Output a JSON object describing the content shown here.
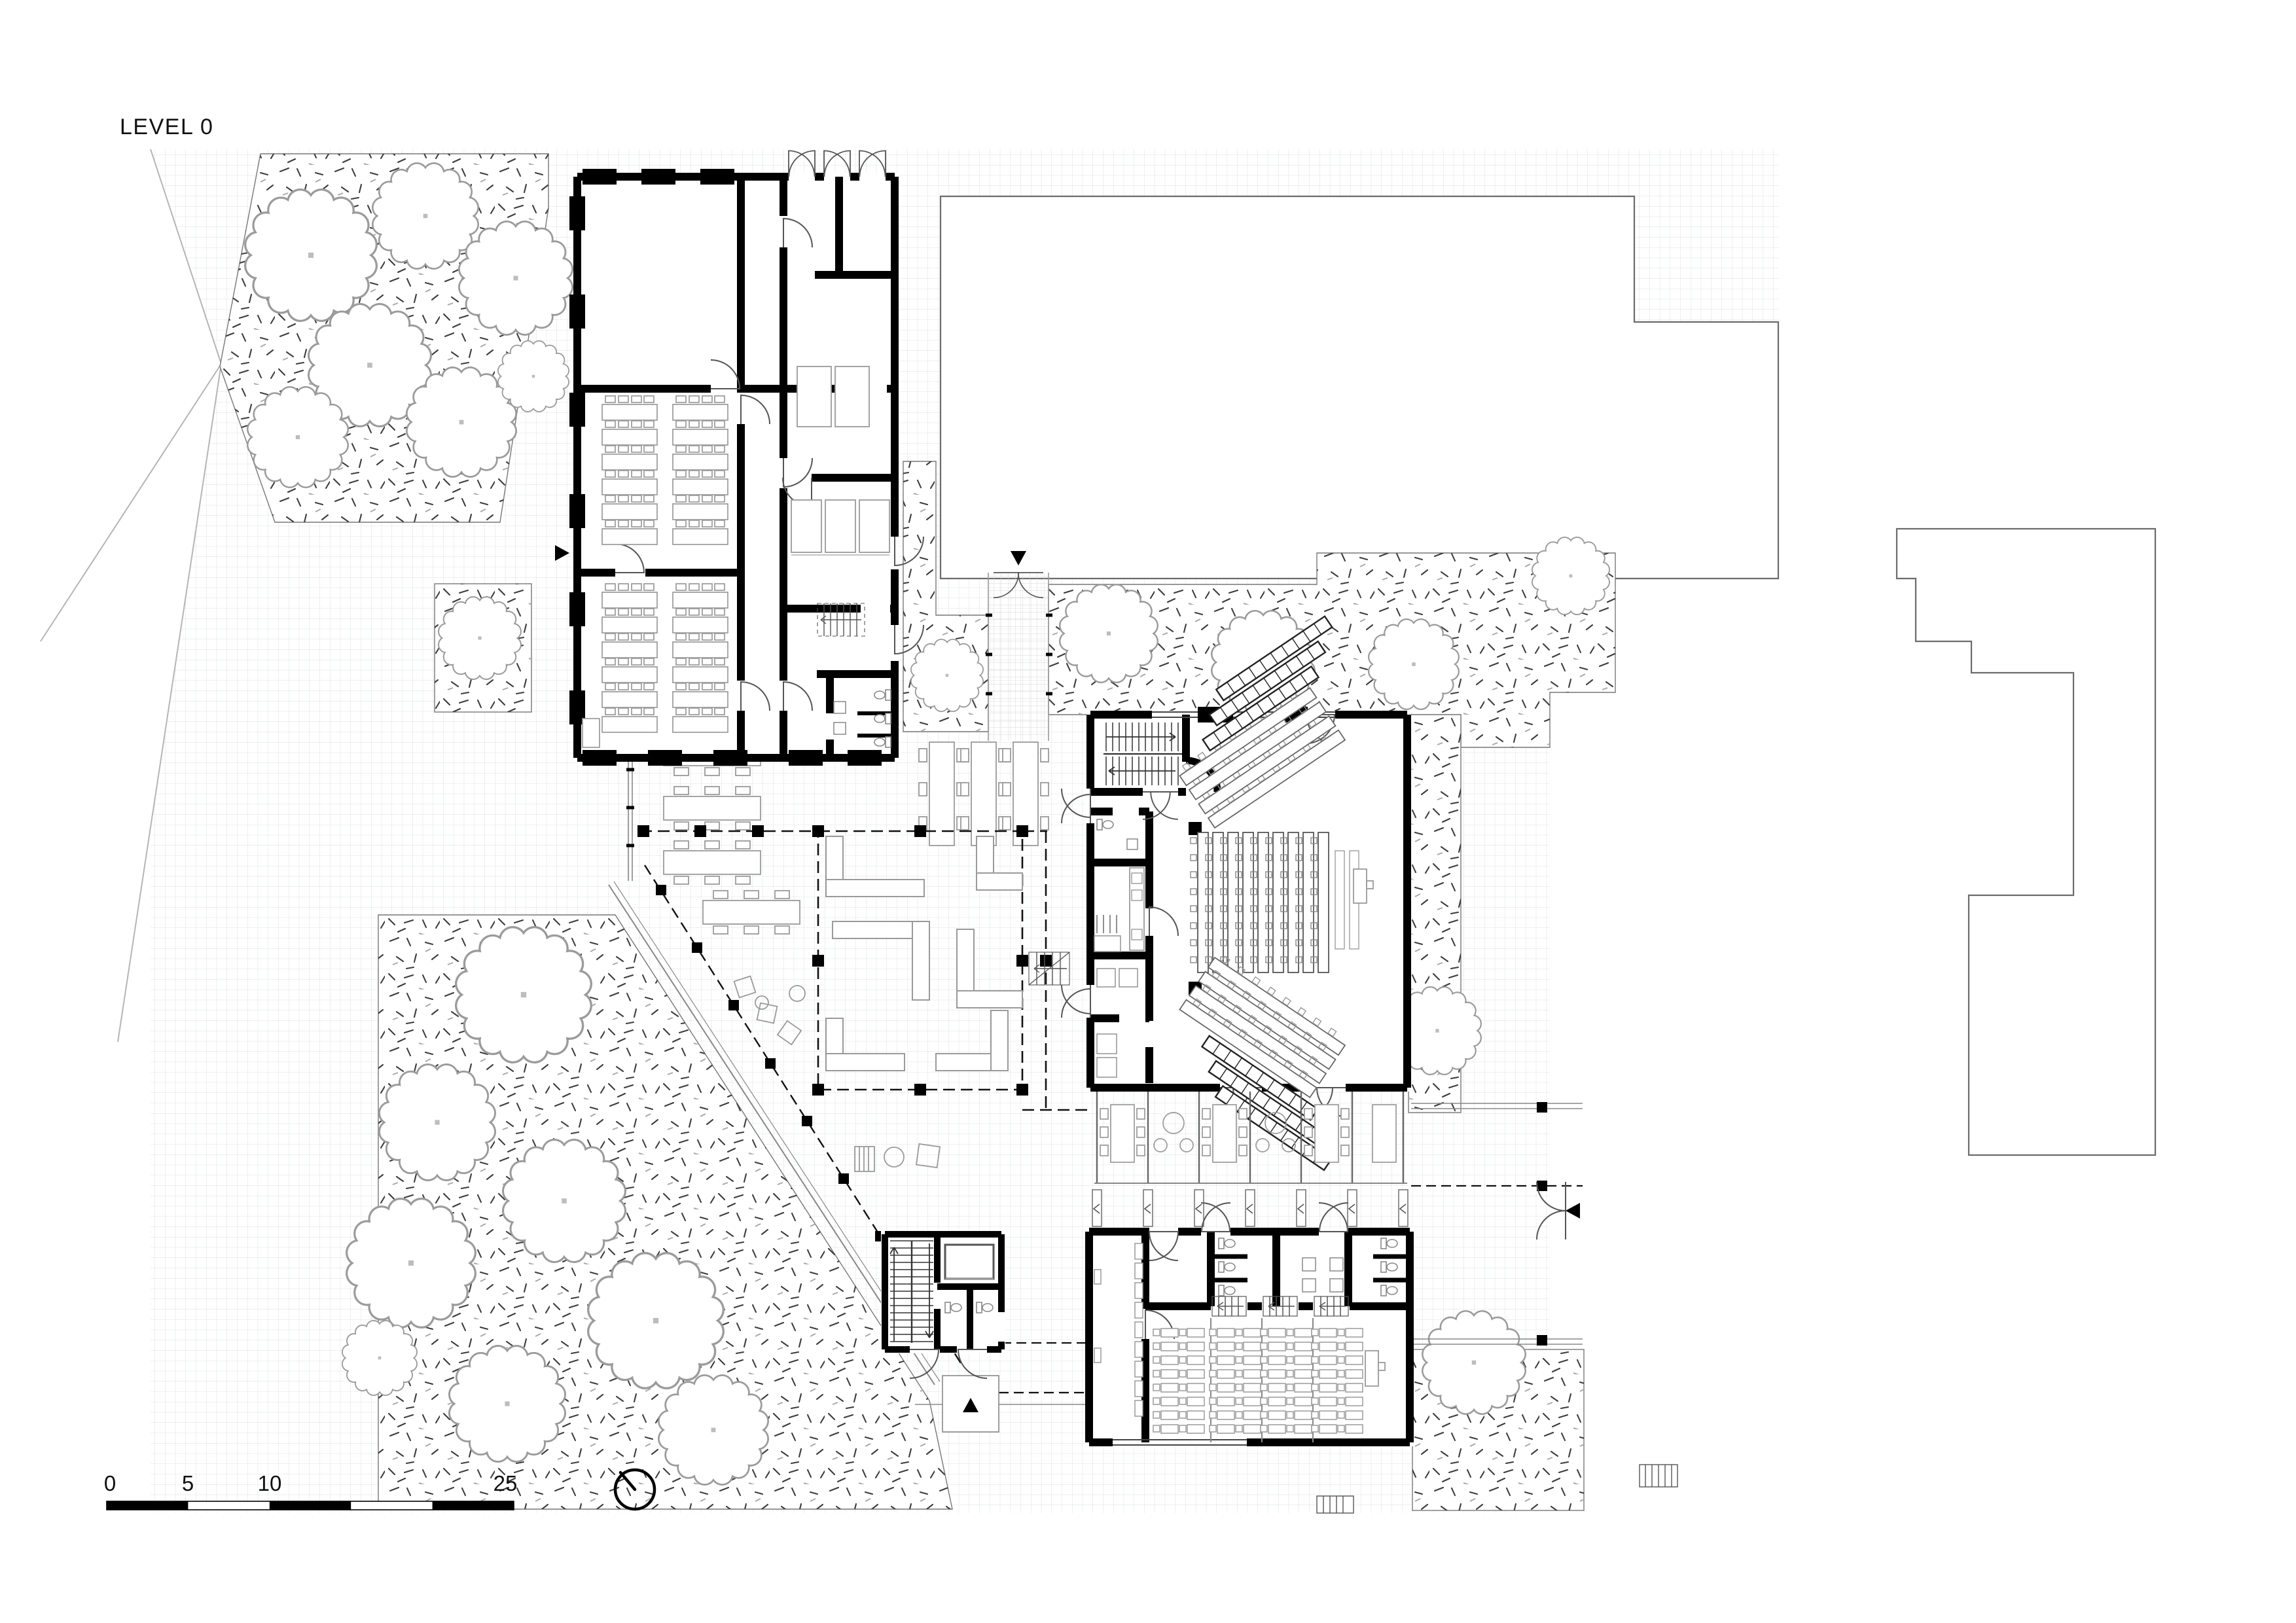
{
  "title": "LEVEL 0",
  "scale_bar": {
    "labels": [
      "0",
      "5",
      "10",
      "25"
    ],
    "values": [
      0,
      5,
      10,
      25
    ],
    "style": "alternating-black-white-bar"
  },
  "icons": {
    "north_indicator": "compass-circle-needle",
    "entrance_marker": "solid-triangle",
    "tree": "scalloped-canopy-outline",
    "stair": "parallel-treads-with-arrow",
    "door": "quarter-circle-swing"
  },
  "palette": {
    "wall": "#000000",
    "furniture_outline": "#9a9a9a",
    "seating_outline": "#555555",
    "tree_outline": "#9b9b9b",
    "plaza_grid": "#dbe3e0",
    "paving_tile": "#d6d6d6",
    "stipple": "#3c3c3c",
    "context_building_outline": "#6b6b6b",
    "canopy_line": "#888888"
  },
  "drawing": {
    "type": "architectural-floor-plan",
    "level_shown": "0",
    "elements": {
      "buildings": [
        "north-classroom-wing",
        "auditorium-hall",
        "south-classroom-building",
        "stair-elevator-core"
      ],
      "context_buildings": 2,
      "courtyard_with_benches": 1,
      "covered_walkways": true,
      "planting_beds_with_trees": true,
      "entrance_markers": 4
    }
  }
}
